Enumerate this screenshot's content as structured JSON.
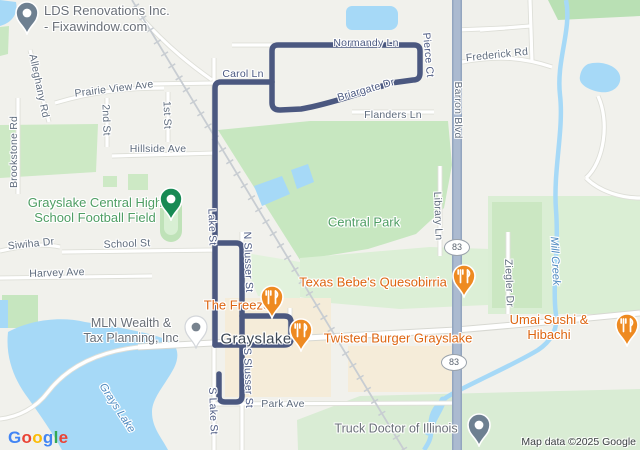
{
  "attribution": "Map data ©2025 Google",
  "google_logo": [
    {
      "ch": "G",
      "color": "#4285F4"
    },
    {
      "ch": "o",
      "color": "#EA4335"
    },
    {
      "ch": "o",
      "color": "#FBBC05"
    },
    {
      "ch": "g",
      "color": "#4285F4"
    },
    {
      "ch": "l",
      "color": "#34A853"
    },
    {
      "ch": "e",
      "color": "#EA4335"
    }
  ],
  "colors": {
    "route": "#4b5880",
    "water": "#a6d9f7",
    "park_green": "#c7e7c0",
    "pale_green": "#dcefd6",
    "highway_fill": "#abbad0",
    "poi_orange": "#dd6511",
    "pin_orange": "#ee8a21",
    "pin_grey": "#6e8091",
    "pin_green": "#188a54"
  },
  "route": {
    "width": 5.5,
    "paths": [
      "M272,82 L221,82 Q215,82 215,88 L215,345",
      "M272,82 L272,51 Q272,45 278,45 L414,45 Q420,45 420,51 L420,73 Q420,80 413,80 L391,83 C362,93 325,105 301,109 L280,110 Q272,110 272,103 L272,82",
      "M215,243 L236,243 Q242,243 242,249 L242,396 Q242,402 236,402 L225,402 Q219,402 219,396 L219,374",
      "M242,316 L284,316 Q291,316 291,322 L291,339 Q291,345 284,345 L215,345"
    ]
  },
  "shields": [
    {
      "label": "83",
      "x": 456,
      "y": 246
    },
    {
      "label": "83",
      "x": 453,
      "y": 361
    }
  ],
  "street_labels": [
    {
      "text": "Brookstone Rd",
      "x": 14,
      "y": 152,
      "rot": -90,
      "kind": "street"
    },
    {
      "text": "Alleghany Rd",
      "x": 39,
      "y": 86,
      "rot": 78,
      "kind": "street"
    },
    {
      "text": "Prairie View Ave",
      "x": 114,
      "y": 89,
      "rot": -7,
      "kind": "street"
    },
    {
      "text": "2nd St",
      "x": 106,
      "y": 120,
      "rot": 88,
      "kind": "street"
    },
    {
      "text": "1st St",
      "x": 167,
      "y": 115,
      "rot": 88,
      "kind": "street"
    },
    {
      "text": "Hillside Ave",
      "x": 158,
      "y": 149,
      "rot": 0,
      "kind": "street"
    },
    {
      "text": "Carol Ln",
      "x": 243,
      "y": 74,
      "rot": 0,
      "kind": "street-route"
    },
    {
      "text": "Normandy Ln",
      "x": 366,
      "y": 43,
      "rot": 0,
      "kind": "street-route"
    },
    {
      "text": "Briargate Dr",
      "x": 366,
      "y": 90,
      "rot": -16,
      "kind": "street-route"
    },
    {
      "text": "Flanders Ln",
      "x": 393,
      "y": 115,
      "rot": 0,
      "kind": "street"
    },
    {
      "text": "Pierce Ct",
      "x": 428,
      "y": 55,
      "rot": 85,
      "kind": "street-route"
    },
    {
      "text": "Frederick Rd",
      "x": 497,
      "y": 55,
      "rot": -6,
      "kind": "street"
    },
    {
      "text": "Barron Blvd",
      "x": 458,
      "y": 110,
      "rot": 90,
      "kind": "street"
    },
    {
      "text": "Library Ln",
      "x": 438,
      "y": 216,
      "rot": 88,
      "kind": "street"
    },
    {
      "text": "Ziegler Dr",
      "x": 509,
      "y": 283,
      "rot": 88,
      "kind": "street"
    },
    {
      "text": "School St",
      "x": 127,
      "y": 244,
      "rot": -2,
      "kind": "street"
    },
    {
      "text": "Harvey Ave",
      "x": 57,
      "y": 273,
      "rot": -2,
      "kind": "street"
    },
    {
      "text": "Siwiha Dr",
      "x": 31,
      "y": 244,
      "rot": -6,
      "kind": "street"
    },
    {
      "text": "Lake St",
      "x": 212,
      "y": 227,
      "rot": 88,
      "kind": "street-route"
    },
    {
      "text": "N Slusser St",
      "x": 248,
      "y": 262,
      "rot": 88,
      "kind": "street-route"
    },
    {
      "text": "S Slusser St",
      "x": 248,
      "y": 378,
      "rot": 88,
      "kind": "street-route"
    },
    {
      "text": "S Lake St",
      "x": 213,
      "y": 411,
      "rot": 88,
      "kind": "street-route"
    },
    {
      "text": "Park Ave",
      "x": 283,
      "y": 404,
      "rot": 0,
      "kind": "street"
    },
    {
      "text": "Mill Creek",
      "x": 555,
      "y": 261,
      "rot": 87,
      "kind": "water"
    },
    {
      "text": "Grays Lake",
      "x": 117,
      "y": 408,
      "rot": 57,
      "kind": "water"
    }
  ],
  "poi_labels": [
    {
      "text": "LDS Renovations Inc.\n- Fixawindow.com",
      "x": 44,
      "y": 3,
      "kind": "grey",
      "align": "left",
      "size": 13,
      "lh": 16,
      "name": "label-lds-renovations"
    },
    {
      "text": "Grayslake Central High\nSchool Football Field",
      "x": 95,
      "y": 210,
      "kind": "green",
      "name": "label-football-field"
    },
    {
      "text": "Central Park",
      "x": 364,
      "y": 222,
      "kind": "green",
      "name": "label-central-park"
    },
    {
      "text": "Texas Bebe's Quesobirria",
      "x": 373,
      "y": 282,
      "kind": "orange",
      "name": "label-texas-bebes"
    },
    {
      "text": "The Freeze",
      "x": 237,
      "y": 305,
      "kind": "orange",
      "name": "label-the-freeze"
    },
    {
      "text": "Twisted Burger Grayslake",
      "x": 398,
      "y": 338,
      "kind": "orange",
      "name": "label-twisted-burger"
    },
    {
      "text": "Umai Sushi & Hibachi",
      "x": 549,
      "y": 327,
      "kind": "orange",
      "name": "label-umai-sushi"
    },
    {
      "text": "MLN Wealth &\nTax Planning, Inc",
      "x": 131,
      "y": 331,
      "kind": "grey",
      "name": "label-mln-wealth"
    },
    {
      "text": "Grayslake",
      "x": 256,
      "y": 339,
      "kind": "city",
      "name": "label-city-grayslake"
    },
    {
      "text": "Truck Doctor of Illinois",
      "x": 396,
      "y": 429,
      "kind": "grey",
      "name": "label-truck-doctor"
    }
  ],
  "pins": [
    {
      "type": "grey-hole",
      "x": 27,
      "y": 13,
      "name": "pin-lds-renovations"
    },
    {
      "type": "green-hole",
      "x": 171,
      "y": 199,
      "name": "pin-football-field"
    },
    {
      "type": "food",
      "x": 272,
      "y": 297,
      "name": "pin-the-freeze"
    },
    {
      "type": "food",
      "x": 464,
      "y": 276,
      "name": "pin-texas-bebes"
    },
    {
      "type": "food",
      "x": 301,
      "y": 330,
      "name": "pin-twisted-burger"
    },
    {
      "type": "food",
      "x": 627,
      "y": 325,
      "name": "pin-umai-sushi"
    },
    {
      "type": "grey-dot",
      "x": 196,
      "y": 327,
      "name": "pin-mln-wealth"
    },
    {
      "type": "grey-hole",
      "x": 479,
      "y": 425,
      "name": "pin-truck-doctor"
    }
  ]
}
